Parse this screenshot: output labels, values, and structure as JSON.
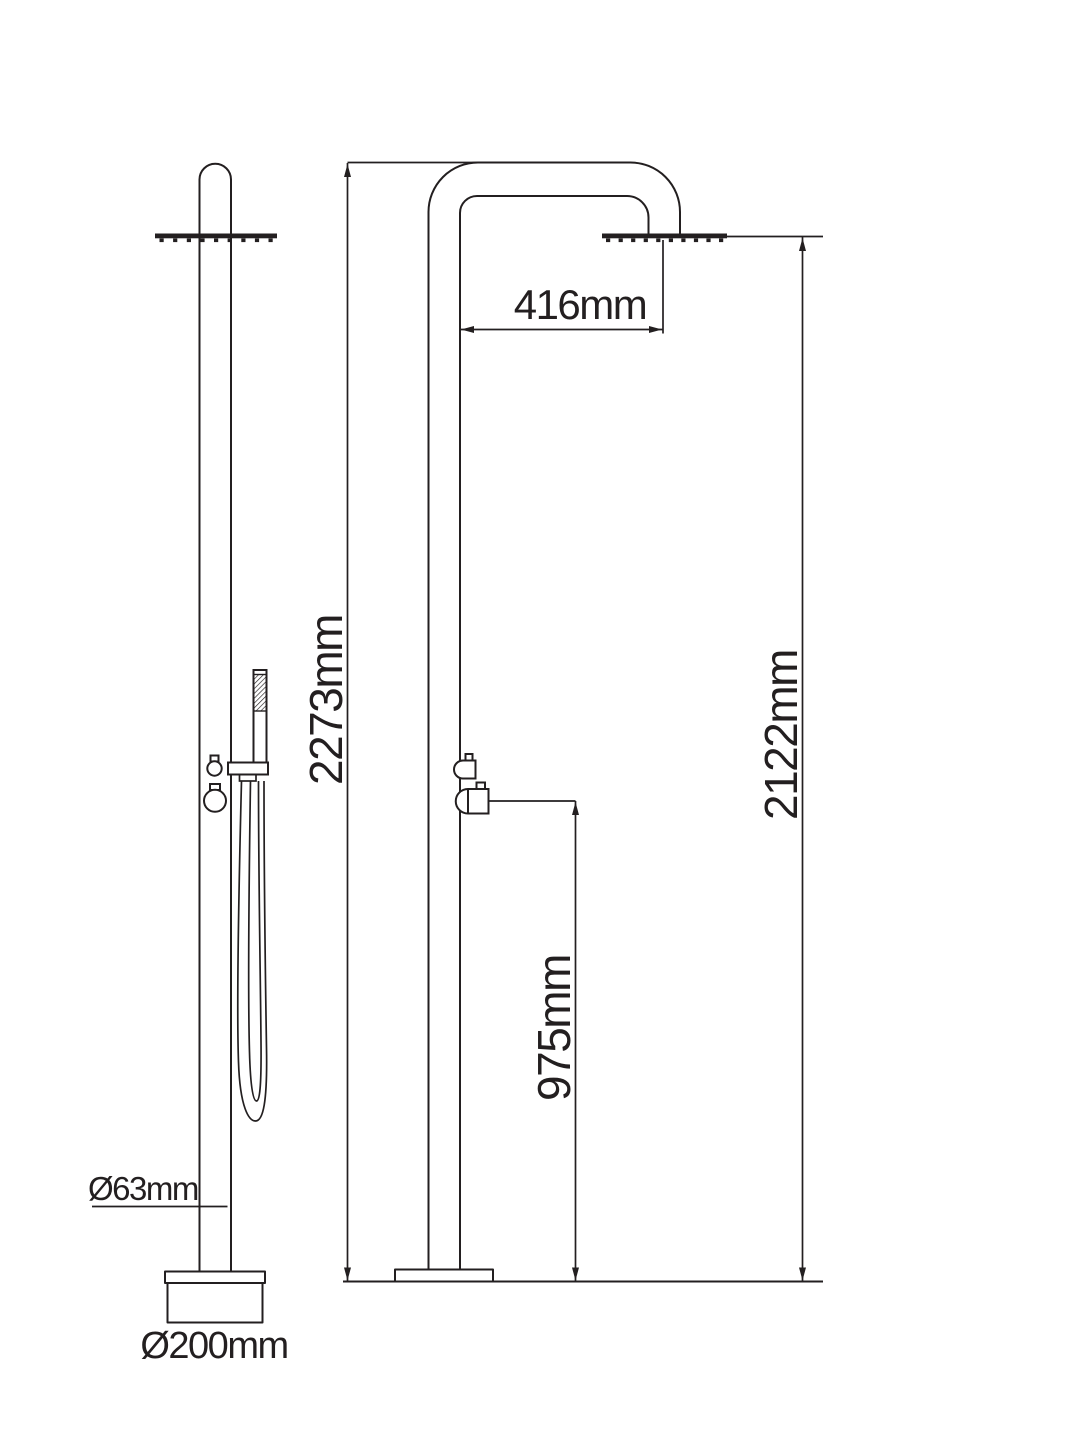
{
  "diagram": {
    "type": "technical-dimension-drawing",
    "colors": {
      "line": "#231f20",
      "background": "#ffffff"
    },
    "labels": {
      "head_offset": "416mm",
      "total_height": "2273mm",
      "head_height": "2122mm",
      "mixer_height": "975mm",
      "column_diameter": "Ø63mm",
      "base_diameter": "Ø200mm"
    }
  }
}
